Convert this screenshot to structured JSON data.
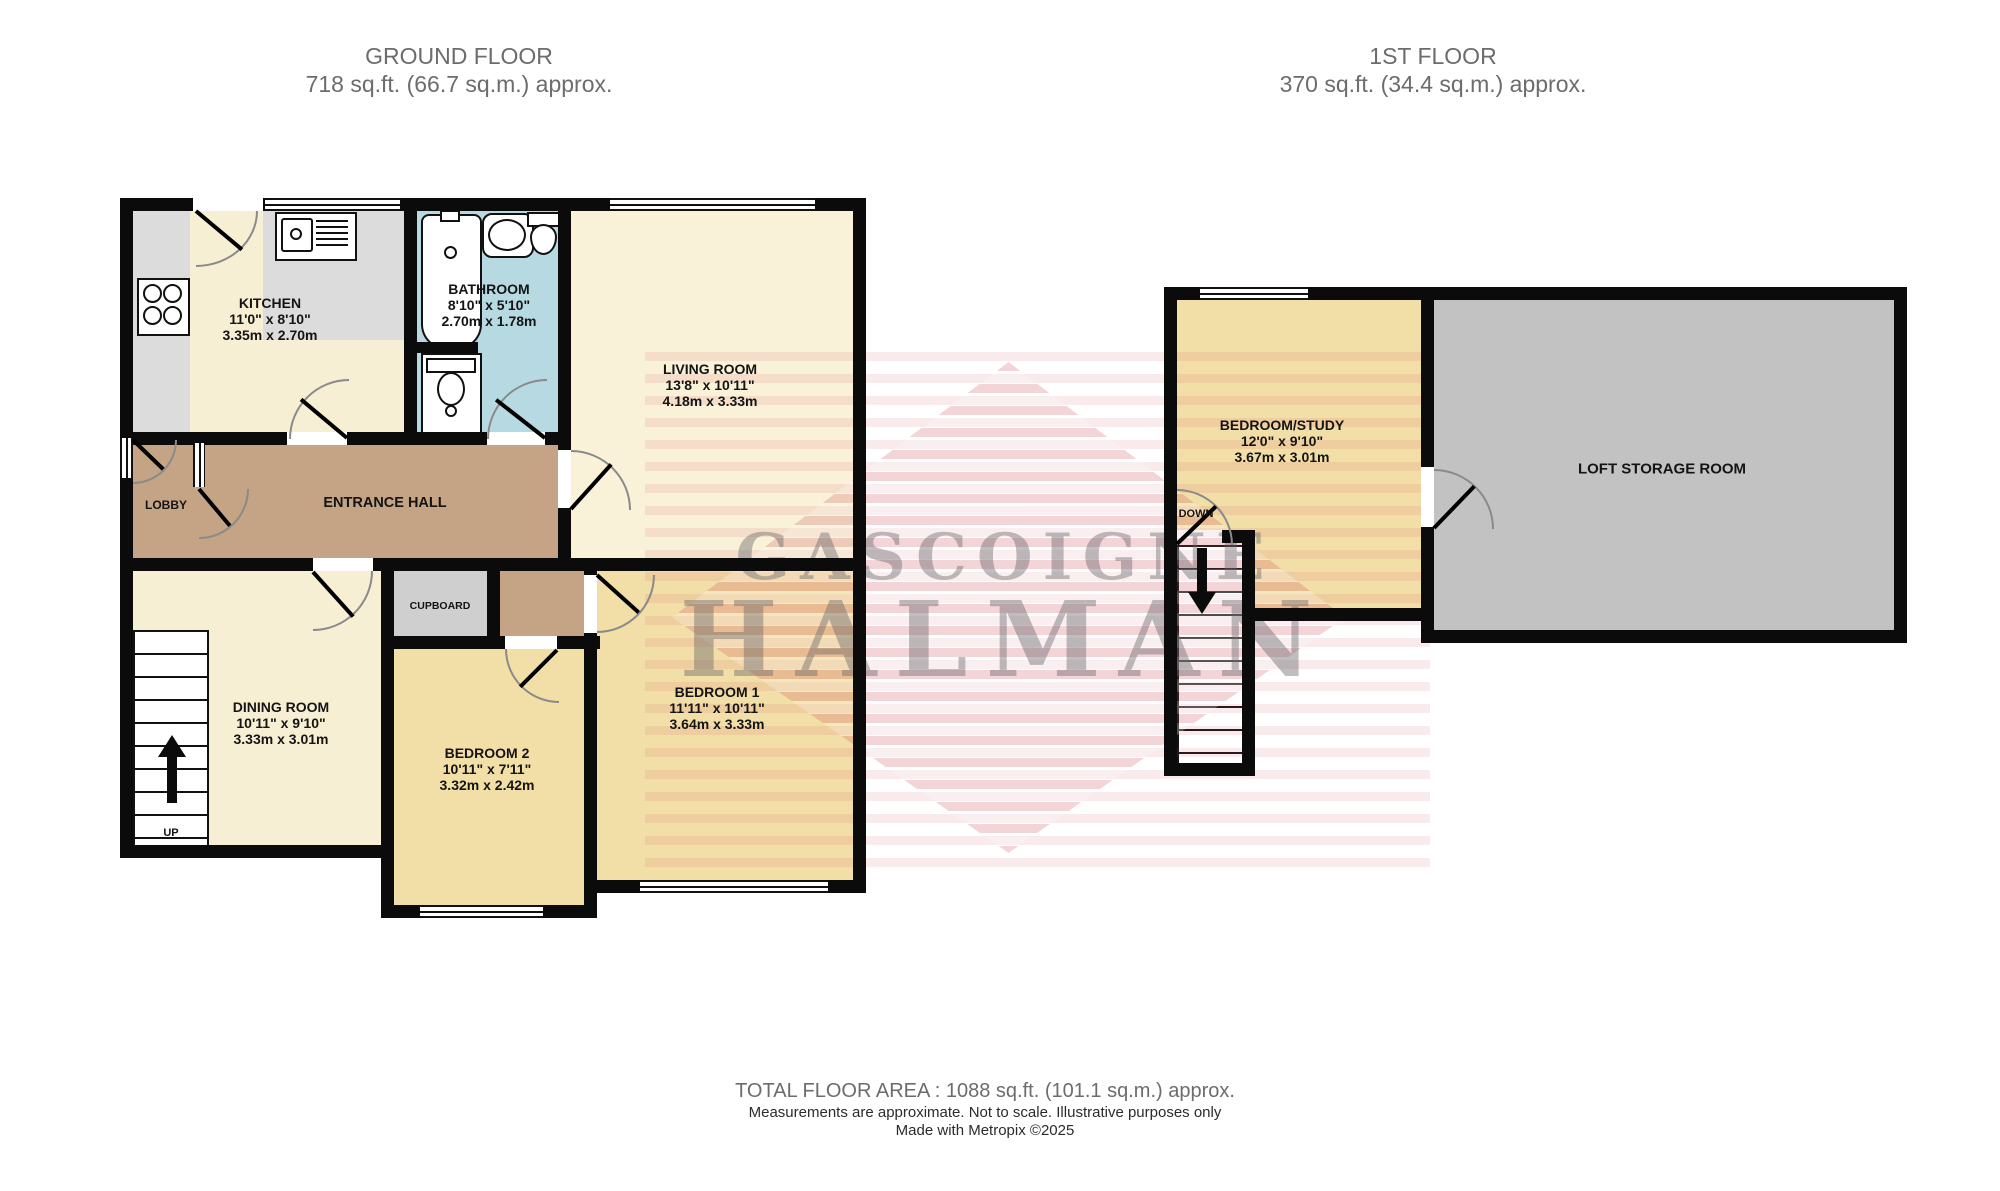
{
  "floors": {
    "ground": {
      "title": "GROUND FLOOR",
      "area": "718 sq.ft. (66.7 sq.m.) approx."
    },
    "first": {
      "title": "1ST FLOOR",
      "area": "370 sq.ft. (34.4 sq.m.) approx."
    }
  },
  "rooms": {
    "kitchen": {
      "name": "KITCHEN",
      "imperial": "11'0\"  x 8'10\"",
      "metric": "3.35m  x 2.70m"
    },
    "bathroom": {
      "name": "BATHROOM",
      "imperial": "8'10\"  x 5'10\"",
      "metric": "2.70m  x 1.78m"
    },
    "living": {
      "name": "LIVING ROOM",
      "imperial": "13'8\"  x 10'11\"",
      "metric": "4.18m  x 3.33m"
    },
    "dining": {
      "name": "DINING ROOM",
      "imperial": "10'11\"  x 9'10\"",
      "metric": "3.33m  x 3.01m"
    },
    "bedroom2": {
      "name": "BEDROOM 2",
      "imperial": "10'11\"  x 7'11\"",
      "metric": "3.32m  x 2.42m"
    },
    "bedroom1": {
      "name": "BEDROOM 1",
      "imperial": "11'11\"  x 10'11\"",
      "metric": "3.64m  x 3.33m"
    },
    "bedroom_study": {
      "name": "BEDROOM/STUDY",
      "imperial": "12'0\"  x 9'10\"",
      "metric": "3.67m  x 3.01m"
    },
    "loft": {
      "name": "LOFT STORAGE ROOM"
    }
  },
  "labels": {
    "lobby": "LOBBY",
    "entrance_hall": "ENTRANCE HALL",
    "cupboard": "CUPBOARD",
    "up": "UP",
    "down": "DOWN"
  },
  "watermark": {
    "line1": "GASCOIGNE",
    "line2": "HALMAN"
  },
  "footer": {
    "total": "TOTAL FLOOR AREA : 1088 sq.ft. (101.1 sq.m.) approx.",
    "disclaimer": "Measurements are approximate.  Not to scale.  Illustrative purposes only",
    "credit": "Made with Metropix ©2025"
  },
  "colors": {
    "wall": "#0b0b0b",
    "kitchen_dining_fill": "#f7efd4",
    "living_fill": "#f9f2d9",
    "bedroom_fill": "#f2dfa7",
    "hall_fill": "#c4a484",
    "bathroom_fill": "#b7dae2",
    "loft_fill": "#c2c2c2",
    "cupboard_fill": "#cfcfcf",
    "counter_fill": "#dcdcdc",
    "watermark_red": "#cf4f5a",
    "watermark_gray": "#6a6a6f",
    "title_gray": "#6c6c6c"
  }
}
